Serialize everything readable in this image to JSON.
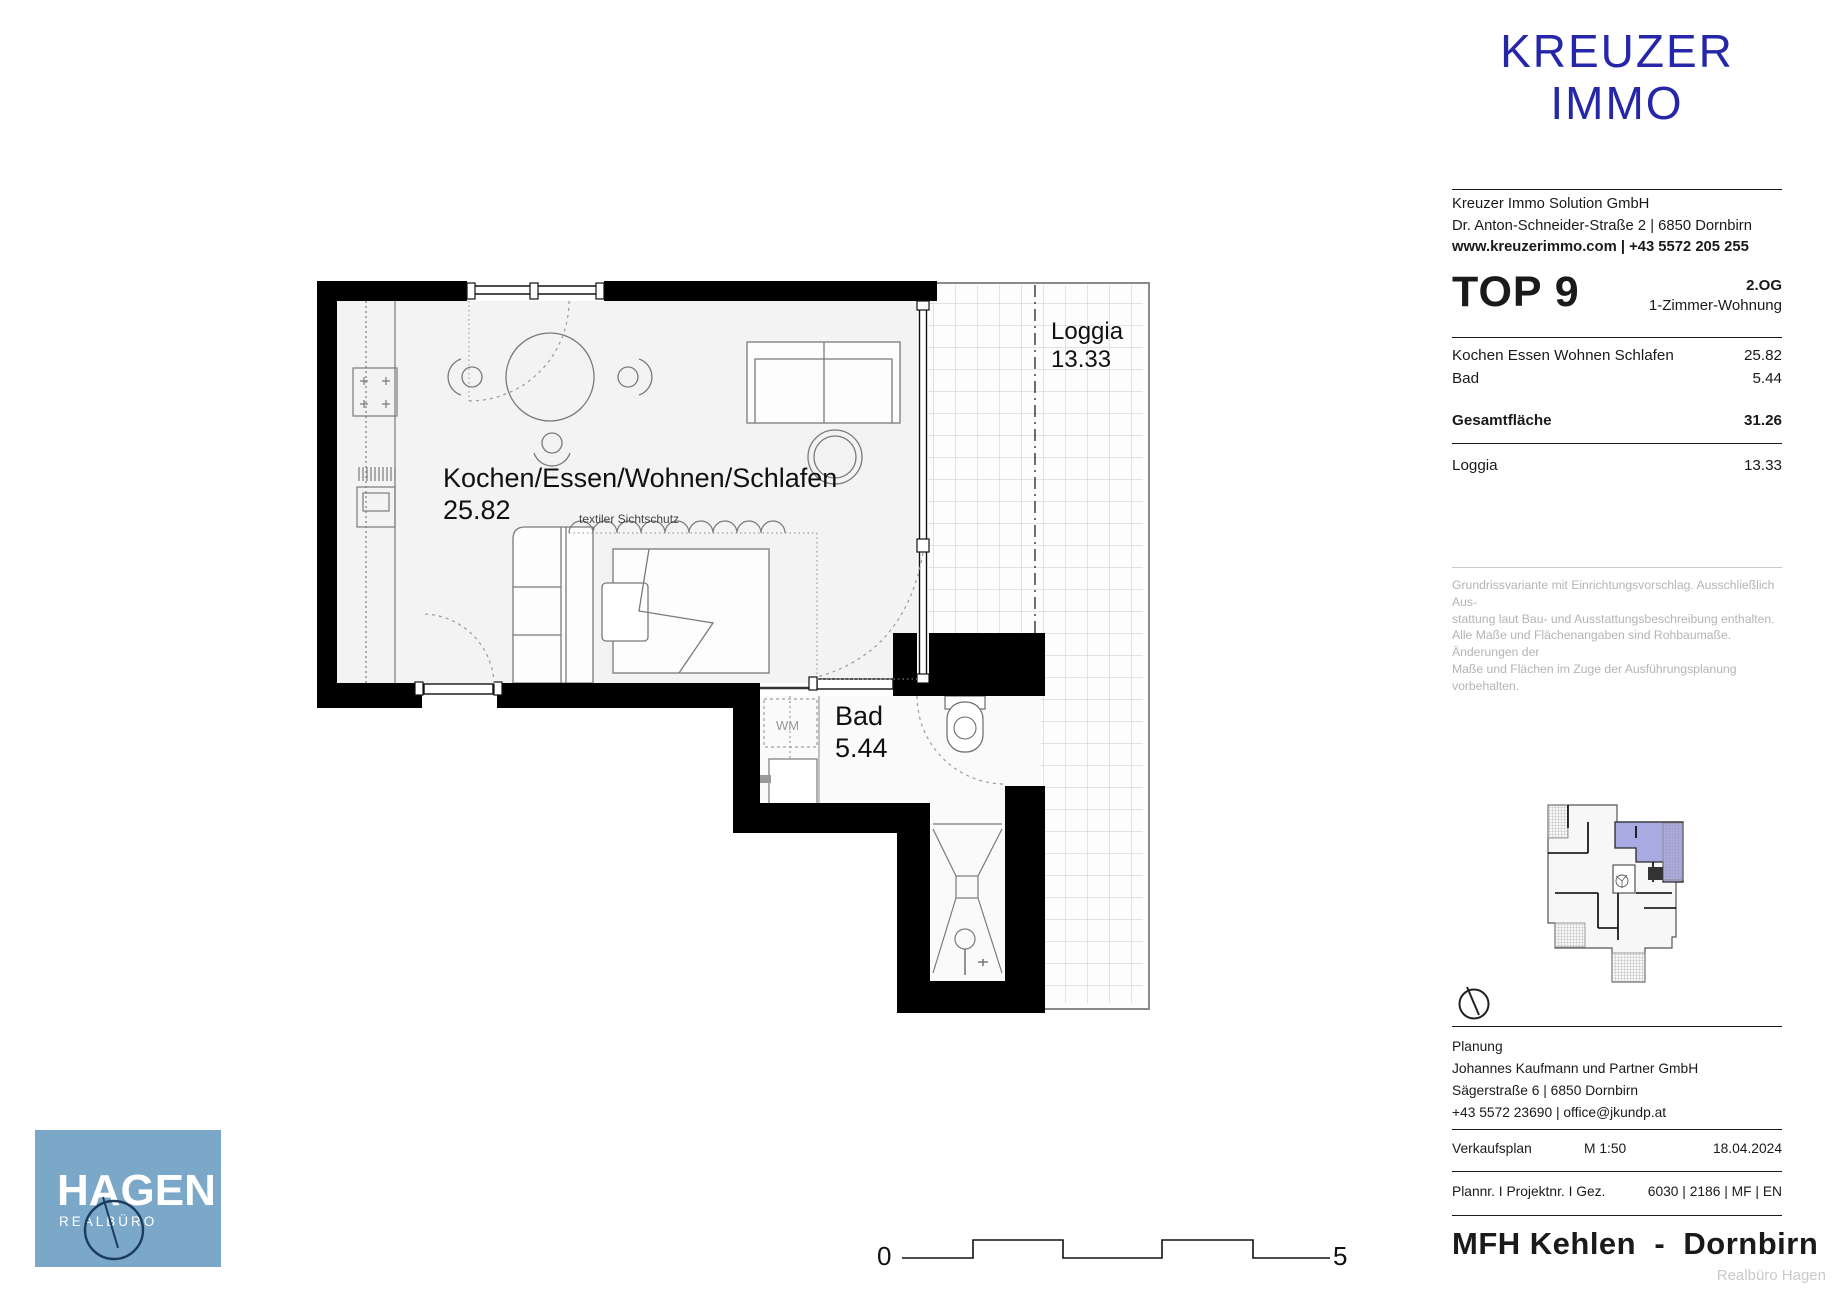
{
  "brand": {
    "logo_line1": "KREUZER",
    "logo_line2": "IMMO",
    "company": "Kreuzer Immo Solution GmbH",
    "address": "Dr. Anton-Schneider-Straße 2 | 6850 Dornbirn",
    "web_phone": "www.kreuzerimmo.com | +43 5572 205 255",
    "accent_color": "#2526a8"
  },
  "unit": {
    "title": "TOP 9",
    "floor": "2.OG",
    "type": "1-Zimmer-Wohnung",
    "rows": [
      {
        "label": "Kochen Essen Wohnen Schlafen",
        "value": "25.82"
      },
      {
        "label": "Bad",
        "value": "5.44"
      }
    ],
    "total_label": "Gesamtfläche",
    "total_value": "31.26",
    "loggia_label": "Loggia",
    "loggia_value": "13.33"
  },
  "disclaimer": {
    "line1": "Grundrissvariante mit Einrichtungsvorschlag. Ausschließlich Aus-",
    "line2": "stattung laut Bau- und Ausstattungsbeschreibung enthalten.",
    "line3": "Alle Maße und Flächenangaben sind Rohbaumaße. Änderungen der",
    "line4": "Maße und Flächen im Zuge der Ausführungsplanung vorbehalten."
  },
  "plan": {
    "room_label": "Kochen/Essen/Wohnen/Schlafen",
    "room_area": "25.82",
    "curtain_label": "textiler Sichtschutz",
    "bad_label": "Bad",
    "bad_area": "5.44",
    "wm_label": "WM",
    "loggia_label": "Loggia",
    "loggia_area": "13.33"
  },
  "scalebar": {
    "start": "0",
    "end": "5"
  },
  "planning": {
    "heading": "Planung",
    "company": "Johannes Kaufmann und Partner GmbH",
    "address": "Sägerstraße 6 | 6850 Dornbirn",
    "contact": "+43 5572 23690 | office@jkundp.at"
  },
  "plan_meta": {
    "doc_type": "Verkaufsplan",
    "scale": "M 1:50",
    "date": "18.04.2024",
    "numbers_label": "Plannr. I Projektnr. I Gez.",
    "numbers_value": "6030 | 2186 | MF | EN"
  },
  "project": {
    "title": "MFH Kehlen  -  Dornbirn",
    "watermark": "Realbüro Hagen"
  },
  "hagen": {
    "name": "HAGEN",
    "subtitle": "REALBÜRO",
    "bg_color": "#7ba7c8",
    "circle_color": "#1c3c5e"
  },
  "mini_plan": {
    "highlight_color": "#a9aae2"
  }
}
